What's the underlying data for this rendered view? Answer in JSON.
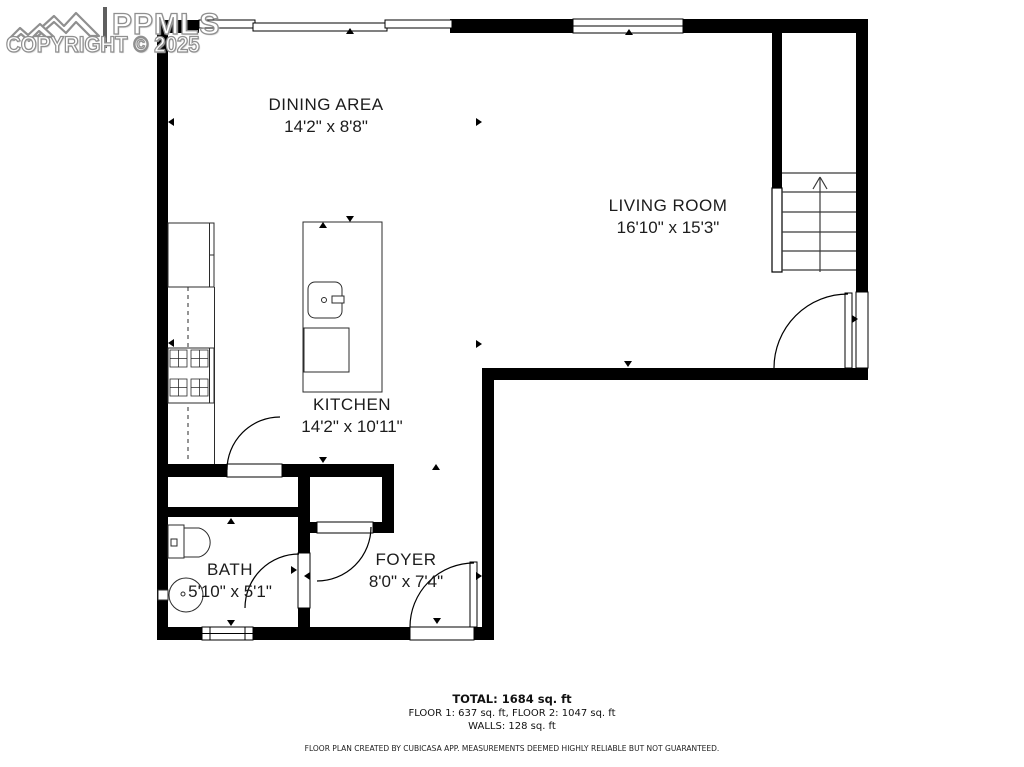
{
  "watermark": {
    "logo": "mountain-logo",
    "brand": "PPMLS",
    "copyright": "COPYRIGHT © 2025"
  },
  "rooms": {
    "dining": {
      "name": "DINING AREA",
      "dims": "14'2\" x 8'8\""
    },
    "living": {
      "name": "LIVING ROOM",
      "dims": "16'10\" x 15'3\""
    },
    "kitchen": {
      "name": "KITCHEN",
      "dims": "14'2\" x 10'11\""
    },
    "bath": {
      "name": "BATH",
      "dims": "5'10\" x 5'1\""
    },
    "foyer": {
      "name": "FOYER",
      "dims": "8'0\" x 7'4\""
    }
  },
  "summary": {
    "total": "TOTAL: 1684 sq. ft",
    "floors": "FLOOR 1: 637 sq. ft, FLOOR 2: 1047 sq. ft",
    "walls": "WALLS: 128 sq. ft",
    "disclaimer": "FLOOR PLAN CREATED BY CUBICASA APP. MEASUREMENTS DEEMED HIGHLY RELIABLE BUT NOT GUARANTEED."
  },
  "colors": {
    "wall": "#000000",
    "text": "#1c1c1c",
    "watermark_stroke": "#8f8f8f"
  }
}
